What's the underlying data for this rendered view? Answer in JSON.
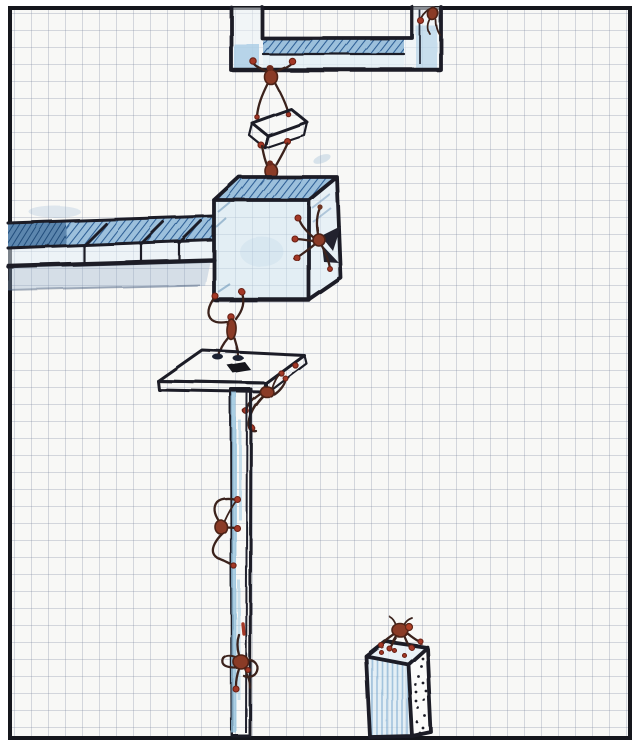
{
  "meta": {
    "title": "Hand-drawn ink sketch on graph paper: ants carrying and climbing rectangular blocks, beams and pillars",
    "medium": "pen and blue pencil on squared paper, black frame border"
  },
  "palette": {
    "pageBg": "#ffffff",
    "paper": "#f8f8f6",
    "gridLine": "rgba(125,135,158,0.30)",
    "frame": "#15161c",
    "ink": "#1b1d27",
    "fillLight": "rgba(208,229,243,0.55)",
    "fillMid": "rgba(168,203,229,0.80)",
    "hatchBg": "#9cc0dc",
    "hatchLine": "#2e5f95",
    "hatchDarkBg": "#5b86ae",
    "hatchDarkLine": "#1f4a78",
    "shadow": "rgba(148,176,203,0.35)",
    "antBody": "#8a3a26",
    "antLimb": "#3a241c",
    "antDot": "#a43827",
    "holeDark": "#12141e"
  },
  "scene": {
    "grid_cell_px": 17,
    "ant_count": 9,
    "objects": [
      {
        "name": "hanging-beam",
        "desc": "staple-shaped beam hanging from top frame, two posts, blue hatched bar"
      },
      {
        "name": "ant-on-right-post",
        "desc": "small ant climbing inner corner of right post"
      },
      {
        "name": "hanging-ant",
        "desc": "ant hanging from beam underside, lowering a small block"
      },
      {
        "name": "carried-block",
        "desc": "small tilted blue-hatched slab held between two ants"
      },
      {
        "name": "ant-on-cube-top",
        "desc": "ant standing on the big cube lifting the small block"
      },
      {
        "name": "stone-cube",
        "desc": "large 3D cube, hatched blue top face"
      },
      {
        "name": "ant-on-cube-side",
        "desc": "dark-winged ant clinging to the cube right face"
      },
      {
        "name": "side-beam",
        "desc": "segmented horizontal beam entering from left frame into the cube"
      },
      {
        "name": "ant-under-cube",
        "desc": "upright ant standing on platform holding the cube above"
      },
      {
        "name": "platform-slab",
        "desc": "thin tabletop slab with dark square hole and dashed right edge"
      },
      {
        "name": "ant-under-platform",
        "desc": "ant hanging off the platform right edge onto the pillar"
      },
      {
        "name": "support-pillar",
        "desc": "tall thin pillar from platform to bottom frame"
      },
      {
        "name": "ant-on-pillar-mid",
        "desc": "ant climbing left side of pillar midway"
      },
      {
        "name": "ant-on-pillar-low",
        "desc": "ant wrapped around pillar near bottom"
      },
      {
        "name": "corner-block",
        "desc": "short rectangular column at lower right, stippled side face"
      },
      {
        "name": "ant-on-corner-block",
        "desc": "ant perched on top of the lower-right column"
      }
    ]
  }
}
